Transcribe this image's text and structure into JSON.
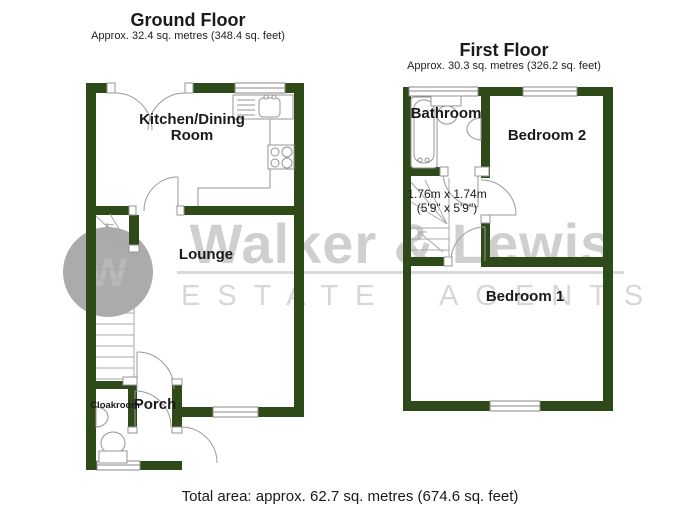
{
  "ground_floor": {
    "title": "Ground Floor",
    "area": "Approx. 32.4 sq. metres (348.4 sq. feet)",
    "rooms": {
      "kitchen": "Kitchen/Dining Room",
      "lounge": "Lounge",
      "porch": "Porch",
      "cloakroom": "Cloakroom"
    }
  },
  "first_floor": {
    "title": "First Floor",
    "area": "Approx. 30.3 sq. metres (326.2 sq. feet)",
    "rooms": {
      "bathroom": "Bathroom",
      "bedroom2": "Bedroom 2",
      "bedroom1": "Bedroom 1"
    },
    "landing_dimensions": {
      "metric": "1.76m x 1.74m",
      "imperial": "(5'9\" x 5'9\")"
    }
  },
  "total_area": "Total area: approx. 62.7 sq. metres (674.6 sq. feet)",
  "watermark": {
    "name": "Walker & Lewis",
    "tagline": "ESTATE AGENTS",
    "monogram": "W"
  },
  "colors": {
    "wall": "#2e4a18",
    "line": "#949494",
    "watermark_text": "#cfcfcf",
    "watermark_circle": "#ababab"
  }
}
